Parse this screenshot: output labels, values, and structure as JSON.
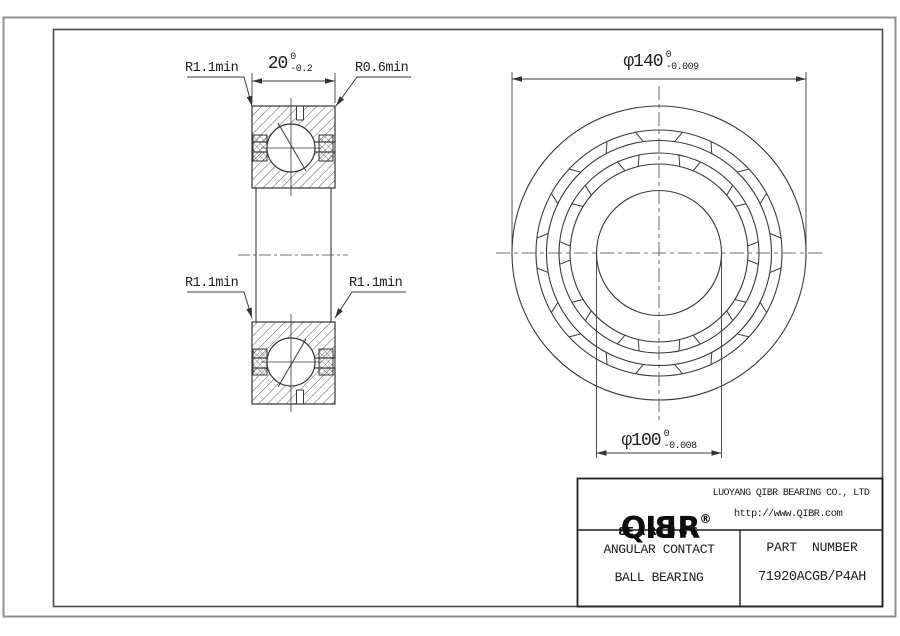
{
  "side_view": {
    "radius_top_left": "R1.1min",
    "radius_top_right": "R0.6min",
    "radius_mid_left": "R1.1min",
    "radius_mid_right": "R1.1min",
    "width_dim": {
      "nominal": "20",
      "tol_upper": "0",
      "tol_lower": "-0.2"
    }
  },
  "front_view": {
    "outer_diameter_dim": {
      "nominal": "φ140",
      "tol_upper": "0",
      "tol_lower": "-0.009"
    },
    "bore_diameter_dim": {
      "nominal": "φ100",
      "tol_upper": "0",
      "tol_lower": "-0.008"
    }
  },
  "title_block": {
    "logo": {
      "letter_q": "Q",
      "letter_i": "I",
      "letter_b": "B",
      "letter_r": "R",
      "registered_mark": "®",
      "bearings_first_letter": "B",
      "bearings_rest": "EARINGS"
    },
    "company_name": "LUOYANG QIBR BEARING CO., LTD",
    "website": "http://www.QIBR.com",
    "product_type_line1": "ANGULAR CONTACT",
    "product_type_line2": "BALL BEARING",
    "part_number_label": "PART  NUMBER",
    "part_number": "71920ACGB/P4AH"
  }
}
